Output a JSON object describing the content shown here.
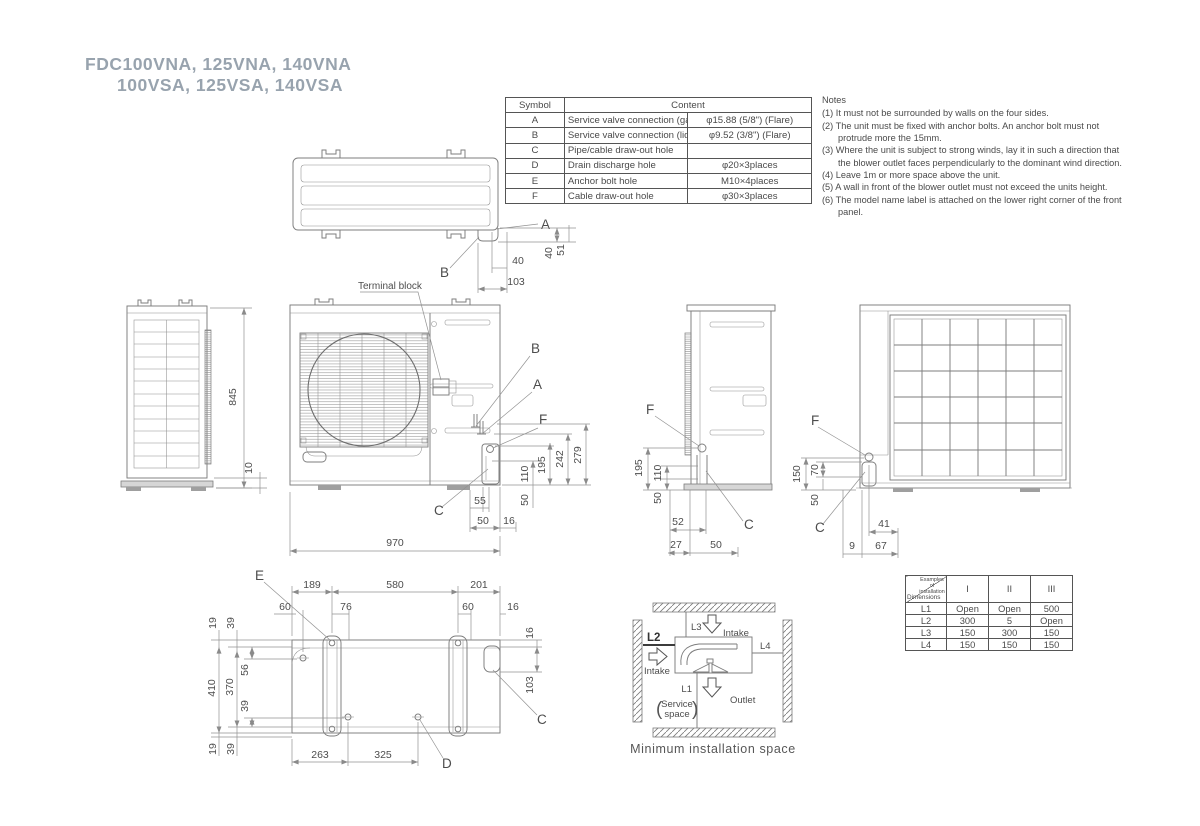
{
  "title": {
    "line1": "FDC100VNA, 125VNA, 140VNA",
    "line2": "100VSA, 125VSA, 140VSA"
  },
  "symbol_table": {
    "header_symbol": "Symbol",
    "header_content": "Content",
    "rows": [
      {
        "symbol": "A",
        "content": "Service valve connection (gas side)",
        "spec": "φ15.88 (5/8\") (Flare)"
      },
      {
        "symbol": "B",
        "content": "Service valve connection (liquid side)",
        "spec": "φ9.52 (3/8\") (Flare)"
      },
      {
        "symbol": "C",
        "content": "Pipe/cable draw-out hole",
        "spec": ""
      },
      {
        "symbol": "D",
        "content": "Drain discharge hole",
        "spec": "φ20×3places"
      },
      {
        "symbol": "E",
        "content": "Anchor bolt hole",
        "spec": "M10×4places"
      },
      {
        "symbol": "F",
        "content": "Cable draw-out hole",
        "spec": "φ30×3places"
      }
    ]
  },
  "notes": {
    "title": "Notes",
    "items": [
      "(1) It must not be surrounded by walls on the four sides.",
      "(2) The unit must be fixed with anchor bolts. An anchor bolt must not protrude more the 15mm.",
      "(3) Where the unit is subject to strong winds, lay it in such a direction that the blower outlet faces perpendicularly to the dominant wind direction.",
      "(4) Leave 1m or more space above the unit.",
      "(5) A wall in front of the blower outlet must not exceed the units height.",
      "(6) The model name label is attached on the lower right corner of the front panel."
    ]
  },
  "labels": {
    "terminal_block": "Terminal block"
  },
  "views": {
    "top": {
      "marks": [
        "A",
        "B"
      ],
      "dims": [
        "40",
        "103",
        "40",
        "51"
      ]
    },
    "left": {
      "dims": [
        "845",
        "10"
      ]
    },
    "front": {
      "marks": [
        "B",
        "A",
        "F",
        "C"
      ],
      "dims": [
        "110",
        "195",
        "242",
        "279",
        "50",
        "55",
        "50",
        "16",
        "970"
      ]
    },
    "side": {
      "marks": [
        "F",
        "C"
      ],
      "dims": [
        "195",
        "110",
        "50",
        "52",
        "27",
        "50"
      ]
    },
    "rear": {
      "marks": [
        "F",
        "C"
      ],
      "dims": [
        "150",
        "70",
        "50",
        "41",
        "9",
        "67"
      ]
    },
    "bottom": {
      "marks": [
        "E",
        "D",
        "C"
      ],
      "dims": [
        "189",
        "580",
        "201",
        "60",
        "76",
        "60",
        "16",
        "19",
        "39",
        "410",
        "370",
        "56",
        "39",
        "19",
        "39",
        "16",
        "103",
        "263",
        "325"
      ]
    }
  },
  "install_space": {
    "l1": "L1",
    "l2": "L2",
    "l3": "L3",
    "l4": "L4",
    "intake_top": "Intake",
    "intake_left": "Intake",
    "outlet": "Outlet",
    "service_open": "(",
    "service_line1": "Service",
    "service_line2": "space",
    "service_close": ")",
    "caption": "Minimum installation space"
  },
  "install_table": {
    "corner_top": "Examples of installation",
    "corner_bottom": "Dimensions",
    "columns": [
      "I",
      "II",
      "III"
    ],
    "rows": [
      {
        "label": "L1",
        "values": [
          "Open",
          "Open",
          "500"
        ]
      },
      {
        "label": "L2",
        "values": [
          "300",
          "5",
          "Open"
        ]
      },
      {
        "label": "L3",
        "values": [
          "150",
          "300",
          "150"
        ]
      },
      {
        "label": "L4",
        "values": [
          "150",
          "150",
          "150"
        ]
      }
    ]
  }
}
